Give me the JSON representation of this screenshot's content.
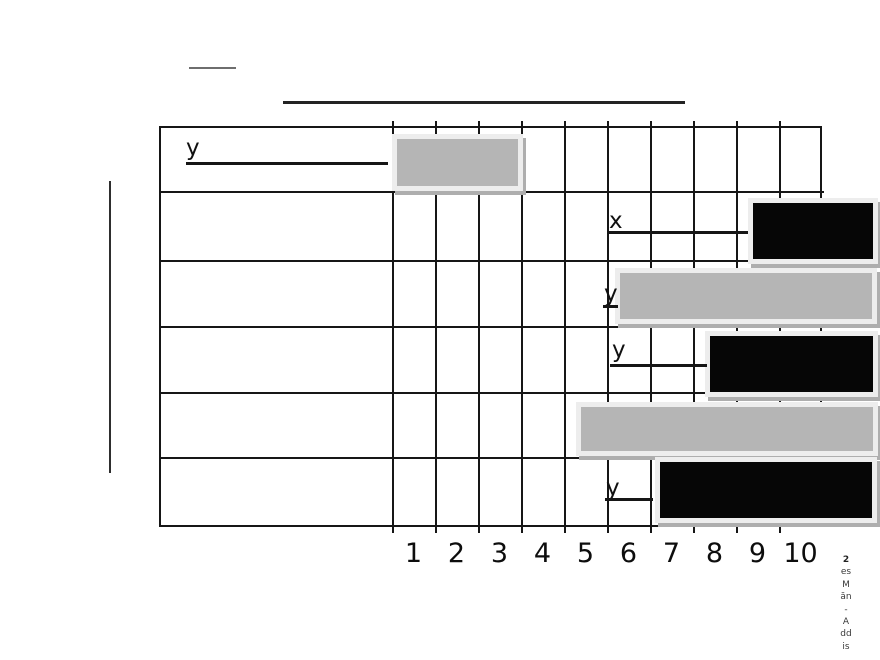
{
  "colors": {
    "gray_bar": "#b5b5b5",
    "black_bar": "#060606",
    "bar_halo": "#ededed",
    "bar_shadow": "#aeaeae",
    "grid_line": "#161616"
  },
  "caption": {
    "lines": [
      "2",
      "es",
      "M",
      "ăn",
      "-",
      "A",
      "dd",
      "is"
    ]
  },
  "chart_data": {
    "type": "bar",
    "orientation": "horizontal",
    "title": "",
    "xlabel": "",
    "ylabel": "",
    "grid": true,
    "x_axis": {
      "ticks": [
        "1",
        "2",
        "3",
        "4",
        "5",
        "6",
        "7",
        "8",
        "9",
        "10"
      ],
      "range": [
        0,
        10
      ],
      "origin_px": 392,
      "unit_width_px": 43
    },
    "rows": [
      {
        "name": "row-1",
        "label": {
          "text": "y",
          "x": 186,
          "y": 136,
          "underline": {
            "x": 186,
            "y": 162,
            "w": 202
          }
        },
        "bar": {
          "color": "#b5b5b5",
          "start_unit": 0.1,
          "end_unit": 2.9,
          "x": 397,
          "y": 139,
          "w": 121,
          "h": 47
        }
      },
      {
        "name": "row-2",
        "label": {
          "text": "x",
          "x": 609,
          "y": 209,
          "underline": {
            "x": 608,
            "y": 231,
            "w": 140
          }
        },
        "bar": {
          "color": "#060606",
          "start_unit": 8.4,
          "end_unit": 11.2,
          "x": 753,
          "y": 203,
          "w": 120,
          "h": 56
        }
      },
      {
        "name": "row-3",
        "label": {
          "text": "y",
          "x": 604,
          "y": 282,
          "underline": {
            "x": 603,
            "y": 305,
            "w": 15
          }
        },
        "bar": {
          "color": "#b5b5b5",
          "start_unit": 5.3,
          "end_unit": 11.2,
          "x": 620,
          "y": 273,
          "w": 252,
          "h": 46
        }
      },
      {
        "name": "row-4",
        "label": {
          "text": "y",
          "x": 612,
          "y": 338,
          "underline": {
            "x": 610,
            "y": 364,
            "w": 97
          }
        },
        "bar": {
          "color": "#060606",
          "start_unit": 7.4,
          "end_unit": 11.2,
          "x": 710,
          "y": 336,
          "w": 163,
          "h": 56
        }
      },
      {
        "name": "row-5",
        "label": null,
        "bar": {
          "color": "#b5b5b5",
          "start_unit": 4.4,
          "end_unit": 11.2,
          "x": 581,
          "y": 407,
          "w": 292,
          "h": 44
        }
      },
      {
        "name": "row-6",
        "label": {
          "text": "y",
          "x": 606,
          "y": 476,
          "underline": {
            "x": 605,
            "y": 498,
            "w": 48
          }
        },
        "bar": {
          "color": "#060606",
          "start_unit": 6.2,
          "end_unit": 11.2,
          "x": 660,
          "y": 462,
          "w": 212,
          "h": 56
        }
      }
    ]
  }
}
